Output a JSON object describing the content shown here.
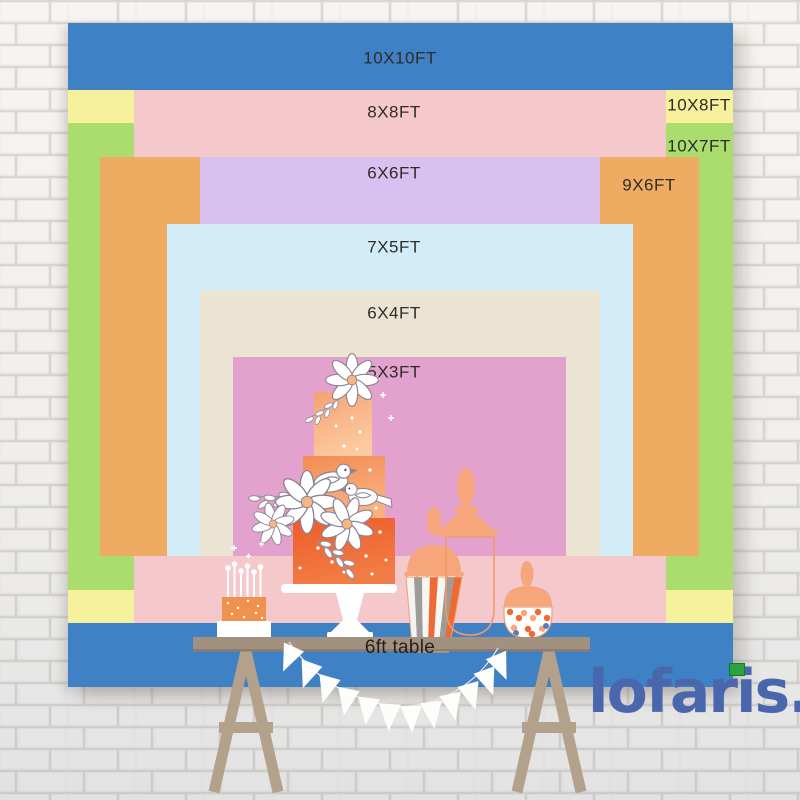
{
  "title": "Backdrop size comparison chart",
  "label_color": "#2f2b28",
  "sizes": [
    {
      "label": "10X10FT",
      "color": "#3e81c5"
    },
    {
      "label": "10X8FT",
      "color": "#f5f19c"
    },
    {
      "label": "10X7FT",
      "color": "#abdc6e"
    },
    {
      "label": "8X8FT",
      "color": "#f5c9cc"
    },
    {
      "label": "9X6FT",
      "color": "#eeab62"
    },
    {
      "label": "6X6FT",
      "color": "#d9c1ef"
    },
    {
      "label": "7X5FT",
      "color": "#d2edf7"
    },
    {
      "label": "6X4FT",
      "color": "#ebe4d3"
    },
    {
      "label": "5X3FT",
      "color": "#e3a2ce"
    }
  ],
  "table": {
    "label": "6ft table"
  },
  "brand": {
    "text": "lofaris.",
    "color": "#4a67ae",
    "flag_color": "#2aa33d"
  },
  "scene_icons": [
    "tiered-cake-icon",
    "candle-cake-icon",
    "popcorn-jar-icon",
    "glass-jar-icon",
    "candy-jar-icon",
    "pennant-banner-icon",
    "dessert-table-icon"
  ]
}
